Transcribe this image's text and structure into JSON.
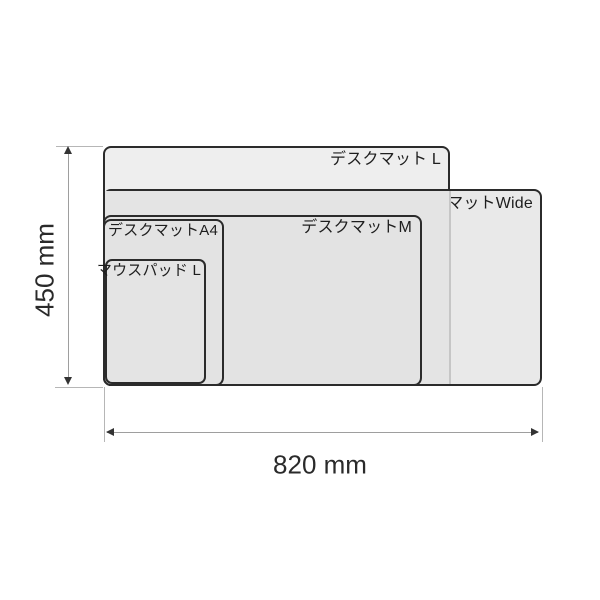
{
  "diagram": {
    "type": "product-size-comparison",
    "items": [
      {
        "id": "desk-mat-l",
        "label": "デスクマット L"
      },
      {
        "id": "desk-mat-wide",
        "label": "デスクマットWide"
      },
      {
        "id": "desk-mat-m",
        "label": "デスクマットM"
      },
      {
        "id": "desk-mat-a4",
        "label": "デスクマットA4"
      },
      {
        "id": "mouse-pad-l",
        "label": "マウスパッド L"
      }
    ],
    "dimensions": {
      "height": "450 mm",
      "width": "820 mm"
    },
    "colors": {
      "outline": "#2b2b2b",
      "fill_light": "#eeeeee",
      "fill_overlap": "#e4e4e4",
      "fill_mid": "#e3e3e3",
      "dimension_line": "#9e9e9e",
      "extension_line": "#b6b6b6",
      "text": "#1e1e1e",
      "background": "#ffffff"
    }
  }
}
